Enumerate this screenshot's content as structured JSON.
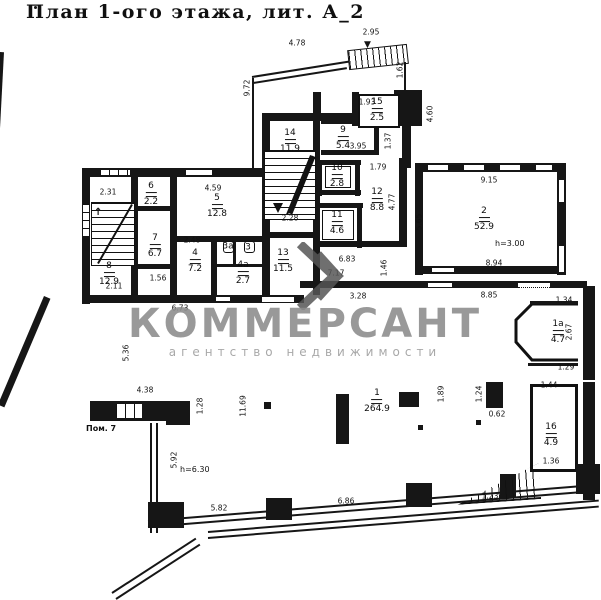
{
  "title": "План 1-ого этажа, лит. А_2",
  "watermark": {
    "name": "КОММЕРСАНТ",
    "tagline": "агентство недвижимости",
    "logo": "chevron-k-logo",
    "color": "#8c8c8c"
  },
  "colors": {
    "ink": "#141414",
    "paper": "#ffffff"
  },
  "plan": {
    "rooms": [
      {
        "number": "8",
        "area": "12.9"
      },
      {
        "number": "6",
        "area": "2.2"
      },
      {
        "number": "7",
        "area": "6.7"
      },
      {
        "number": "5",
        "area": "12.8"
      },
      {
        "number": "4",
        "area": "7.2"
      },
      {
        "number": "3а",
        "area": ""
      },
      {
        "number": "3",
        "area": ""
      },
      {
        "number": "4а",
        "area": "2.7"
      },
      {
        "number": "14",
        "area": "11.9"
      },
      {
        "number": "13",
        "area": "11.5"
      },
      {
        "number": "9",
        "area": "5.4"
      },
      {
        "number": "15",
        "area": "2.5"
      },
      {
        "number": "10",
        "area": "2.8"
      },
      {
        "number": "11",
        "area": "4.6"
      },
      {
        "number": "12",
        "area": "8.8"
      },
      {
        "number": "2",
        "area": "52.9"
      },
      {
        "number": "1а",
        "area": "4.7"
      },
      {
        "number": "16",
        "area": "4.9"
      },
      {
        "number": "1",
        "area": "264.9"
      }
    ],
    "notes": [
      {
        "text": "Пом. 7"
      },
      {
        "text": "h=6.30"
      },
      {
        "text": "h=3.00"
      }
    ],
    "dimensions": [
      {
        "text": "4.78"
      },
      {
        "text": "2.95"
      },
      {
        "text": "9.72"
      },
      {
        "text": "1.62"
      },
      {
        "text": "1.93"
      },
      {
        "text": "4.60"
      },
      {
        "text": "1.37"
      },
      {
        "text": "3.95"
      },
      {
        "text": "1.79"
      },
      {
        "text": "4.77"
      },
      {
        "text": "2.31"
      },
      {
        "text": "4.59"
      },
      {
        "text": "9.15"
      },
      {
        "text": "5.65"
      },
      {
        "text": "2.48"
      },
      {
        "text": "2.28"
      },
      {
        "text": "8.94"
      },
      {
        "text": "6.83"
      },
      {
        "text": "7.17"
      },
      {
        "text": "1.46"
      },
      {
        "text": "8.85"
      },
      {
        "text": "3.28"
      },
      {
        "text": "6.73"
      },
      {
        "text": "1.34"
      },
      {
        "text": "2.67"
      },
      {
        "text": "1.29"
      },
      {
        "text": "1.44"
      },
      {
        "text": "1.36"
      },
      {
        "text": "1.56"
      },
      {
        "text": "2.11"
      },
      {
        "text": "5.36"
      },
      {
        "text": "4.38"
      },
      {
        "text": "1.28"
      },
      {
        "text": "11.69"
      },
      {
        "text": "1.89"
      },
      {
        "text": "1.24"
      },
      {
        "text": "0.62"
      },
      {
        "text": "5.92"
      },
      {
        "text": "5.82"
      },
      {
        "text": "6.86"
      },
      {
        "text": "1.23"
      }
    ]
  }
}
